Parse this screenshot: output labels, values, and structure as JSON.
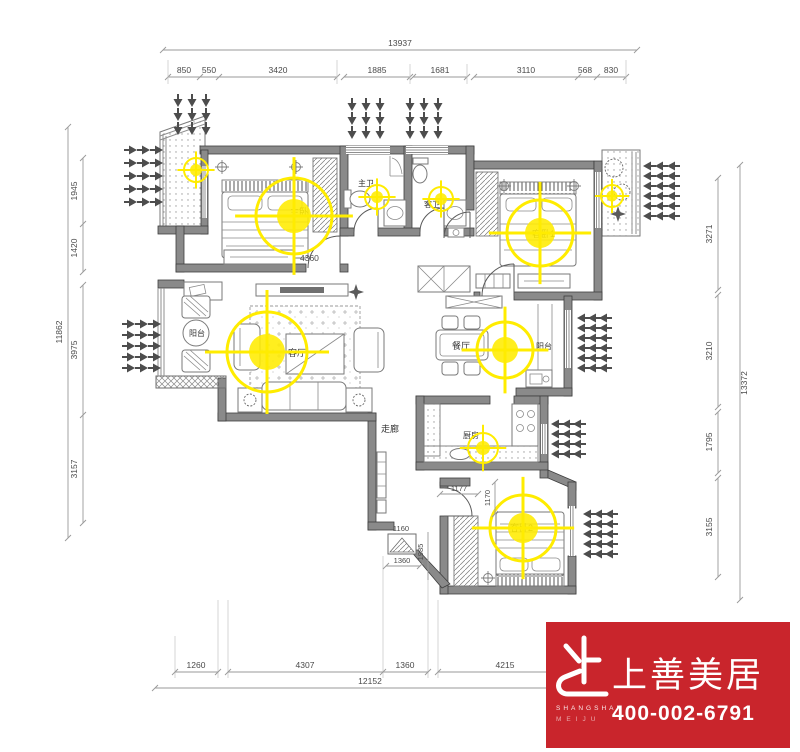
{
  "dims": {
    "top": {
      "total": "13937",
      "segments": [
        "850",
        "550",
        "3420",
        "1885",
        "1681",
        "3110",
        "568",
        "830"
      ]
    },
    "left": {
      "total": "11862",
      "segments": [
        "1945",
        "1420",
        "3975",
        "3157"
      ]
    },
    "right": {
      "total": "13372",
      "segments": [
        "3271",
        "3210",
        "1795",
        "3155"
      ]
    },
    "bottom": {
      "total": "12152",
      "segments": [
        "1260",
        "4307",
        "1360",
        "4215"
      ]
    },
    "interior": {
      "master_width": "4360",
      "corridor_a": "1177",
      "corridor_b": "1170",
      "shaft_top": "1160",
      "shaft_bottom": "1360",
      "shaft_side": "1985"
    }
  },
  "rooms": {
    "master_bedroom": "主卧",
    "master_bath": "主卫",
    "guest_bath": "客卫",
    "bedroom2": "客卧1",
    "bedroom3": "客卧2",
    "living_room": "客厅",
    "dining_room": "餐厅",
    "kitchen": "厨房",
    "corridor": "走廊",
    "balcony_left": "阳台",
    "balcony_dining": "阳台"
  },
  "logo": {
    "brand": "上善美居",
    "brand_en_1": "SHANGSHAN",
    "brand_en_2": "MEIJU",
    "phone": "400-002-6791"
  },
  "colors": {
    "accent_red": "#c9252c",
    "light_yellow": "#ffec00",
    "wall_gray": "#8a8a8a"
  }
}
